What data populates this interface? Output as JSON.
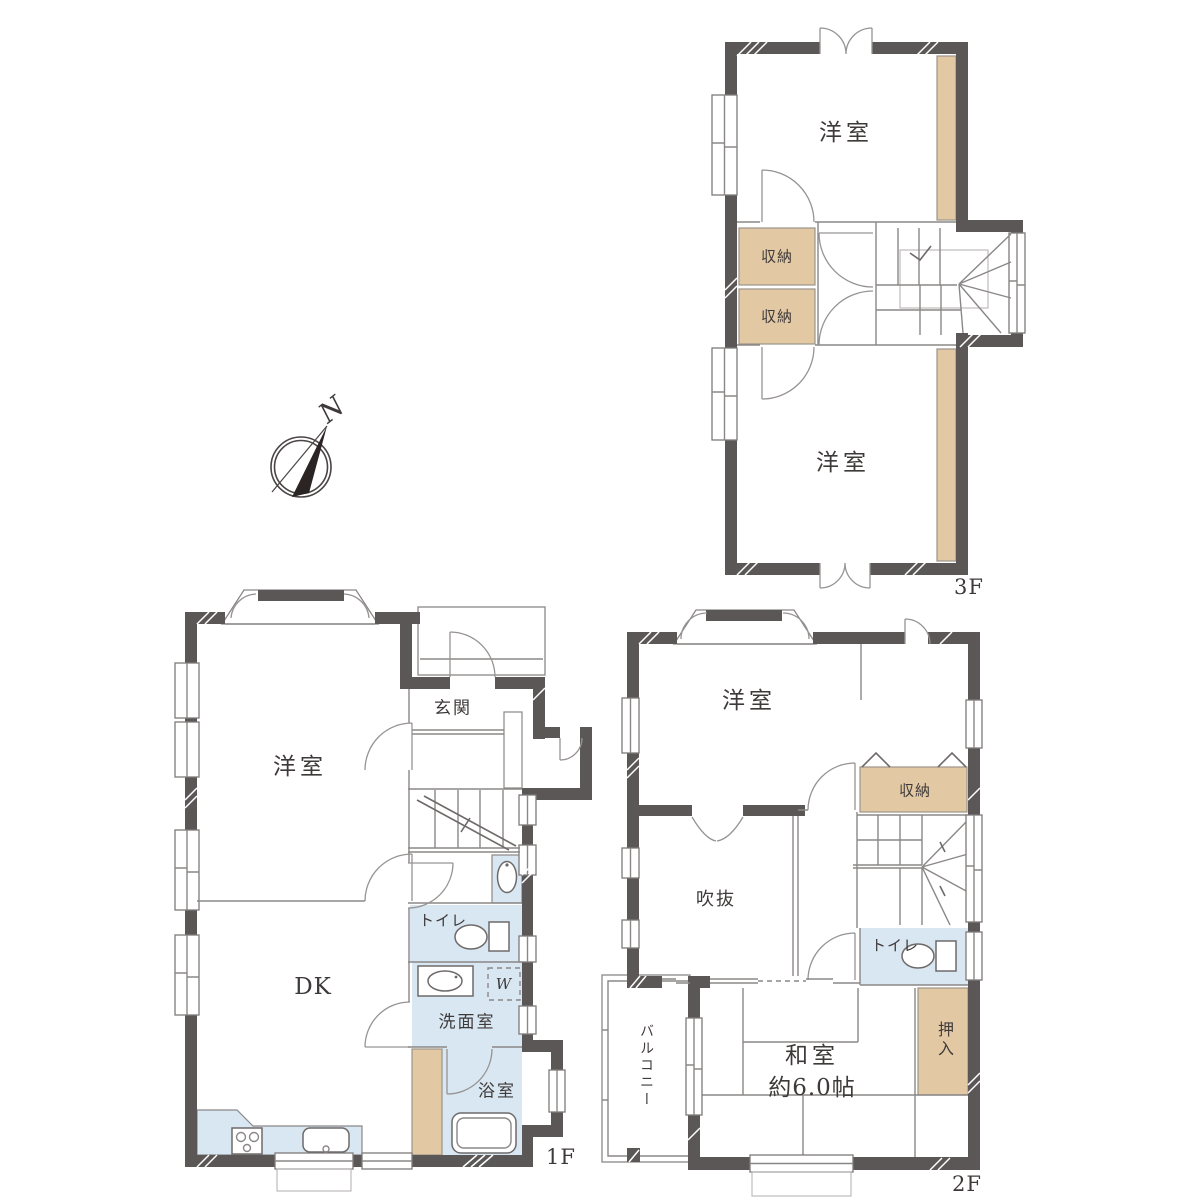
{
  "compass": {
    "north_label": "N"
  },
  "floors": {
    "f1": {
      "floor_label": "1F",
      "rooms": {
        "entrance": "玄関",
        "western_room": "洋室",
        "dining_kitchen": "DK",
        "toilet": "トイレ",
        "washroom": "洗面室",
        "washer_symbol": "W",
        "bathroom": "浴室"
      }
    },
    "f2": {
      "floor_label": "2F",
      "rooms": {
        "western_room": "洋室",
        "storage": "収納",
        "void": "吹抜",
        "toilet": "トイレ",
        "balcony": "バルコニー",
        "japanese_room": "和室",
        "japanese_room_size": "約6.0帖",
        "closet": "押入"
      }
    },
    "f3": {
      "floor_label": "3F",
      "rooms": {
        "western_room_north": "洋室",
        "western_room_south": "洋室",
        "storage_upper": "収納",
        "storage_lower": "収納"
      }
    }
  },
  "colors": {
    "wall": "#5b5757",
    "storage_fill": "#e2c9a4",
    "water_area_fill": "#d8e7f2",
    "line": "#8b8787",
    "text": "#3f3a3a"
  }
}
